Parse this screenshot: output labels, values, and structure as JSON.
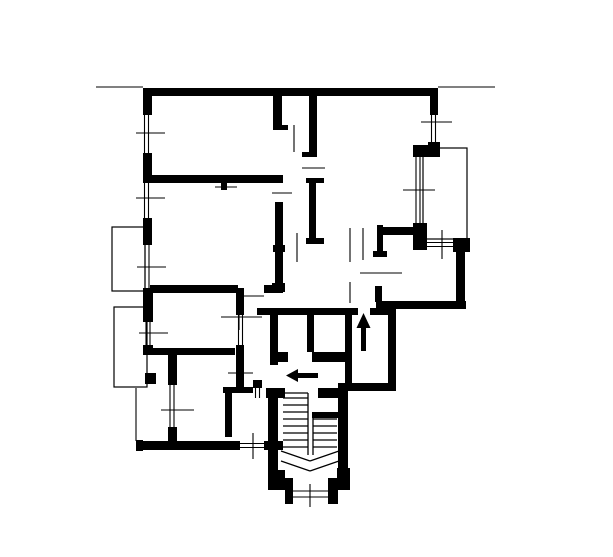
{
  "plan": {
    "background": "#ffffff",
    "ink": "#000000",
    "canvas": {
      "width": 613,
      "height": 557
    },
    "walls": [
      [
        143,
        88,
        295,
        8
      ],
      [
        143,
        88,
        9,
        27
      ],
      [
        143,
        153,
        9,
        30
      ],
      [
        143,
        218,
        9,
        27
      ],
      [
        143,
        288,
        10,
        34
      ],
      [
        143,
        345,
        10,
        10
      ],
      [
        143,
        348,
        92,
        7
      ],
      [
        168,
        355,
        9,
        30
      ],
      [
        168,
        427,
        9,
        14
      ],
      [
        136,
        440,
        7,
        11
      ],
      [
        136,
        441,
        104,
        9
      ],
      [
        264,
        441,
        19,
        9
      ],
      [
        268,
        390,
        10,
        82
      ],
      [
        268,
        470,
        17,
        20
      ],
      [
        285,
        478,
        8,
        20
      ],
      [
        285,
        496,
        8,
        8
      ],
      [
        328,
        496,
        10,
        8
      ],
      [
        328,
        478,
        10,
        20
      ],
      [
        337,
        468,
        13,
        22
      ],
      [
        338,
        398,
        10,
        72
      ],
      [
        266,
        388,
        19,
        10
      ],
      [
        318,
        388,
        30,
        10
      ],
      [
        338,
        383,
        58,
        8
      ],
      [
        388,
        313,
        8,
        72
      ],
      [
        376,
        301,
        90,
        8
      ],
      [
        375,
        286,
        7,
        16
      ],
      [
        456,
        250,
        9,
        55
      ],
      [
        453,
        238,
        17,
        14
      ],
      [
        413,
        223,
        14,
        27
      ],
      [
        413,
        145,
        27,
        12
      ],
      [
        430,
        88,
        8,
        27
      ],
      [
        428,
        142,
        12,
        13
      ],
      [
        273,
        96,
        9,
        34
      ],
      [
        282,
        125,
        6,
        5
      ],
      [
        309,
        96,
        8,
        61
      ],
      [
        302,
        152,
        7,
        5
      ],
      [
        152,
        175,
        131,
        8
      ],
      [
        221,
        183,
        6,
        7
      ],
      [
        275,
        202,
        8,
        43
      ],
      [
        273,
        245,
        12,
        7
      ],
      [
        275,
        252,
        8,
        31
      ],
      [
        272,
        283,
        13,
        9
      ],
      [
        309,
        178,
        7,
        65
      ],
      [
        306,
        178,
        18,
        5
      ],
      [
        306,
        238,
        18,
        6
      ],
      [
        257,
        308,
        101,
        7
      ],
      [
        370,
        308,
        26,
        7
      ],
      [
        270,
        315,
        8,
        37
      ],
      [
        307,
        315,
        7,
        37
      ],
      [
        345,
        315,
        7,
        68
      ],
      [
        278,
        352,
        10,
        10
      ],
      [
        312,
        352,
        33,
        10
      ],
      [
        270,
        352,
        8,
        13
      ],
      [
        377,
        225,
        6,
        32
      ],
      [
        373,
        251,
        14,
        6
      ],
      [
        377,
        227,
        43,
        8
      ],
      [
        236,
        288,
        8,
        27
      ],
      [
        236,
        345,
        8,
        48
      ],
      [
        223,
        387,
        30,
        6
      ],
      [
        225,
        387,
        7,
        50
      ],
      [
        253,
        380,
        9,
        8
      ],
      [
        150,
        285,
        88,
        8
      ],
      [
        264,
        285,
        19,
        8
      ],
      [
        312,
        412,
        26,
        6
      ]
    ],
    "windows": [
      {
        "lines": [
          [
            144.5,
            115,
            144.5,
            153
          ],
          [
            148.5,
            115,
            148.5,
            153
          ]
        ],
        "tick": [
          136,
          133,
          165,
          133
        ]
      },
      {
        "lines": [
          [
            144.5,
            183,
            144.5,
            218
          ],
          [
            148.5,
            183,
            148.5,
            218
          ]
        ],
        "tick": [
          136,
          198,
          165,
          198
        ]
      },
      {
        "lines": [
          [
            145,
            245,
            145,
            288
          ],
          [
            149,
            245,
            149,
            288
          ]
        ],
        "tick": [
          137,
          267,
          166,
          267
        ]
      },
      {
        "lines": [
          [
            146,
            322,
            146,
            345
          ],
          [
            150,
            322,
            150,
            345
          ]
        ],
        "tick": [
          139,
          333,
          168,
          333
        ]
      },
      {
        "lines": [
          [
            170,
            385,
            170,
            427
          ],
          [
            174,
            385,
            174,
            427
          ]
        ],
        "tick": [
          161,
          410,
          194,
          410
        ]
      },
      {
        "lines": [
          [
            240,
            443.5,
            264,
            443.5
          ],
          [
            240,
            447.5,
            264,
            447.5
          ]
        ],
        "tick": [
          253,
          433,
          253,
          459
        ]
      },
      {
        "lines": [
          [
            293,
            491,
            328,
            491
          ],
          [
            293,
            497,
            328,
            497
          ]
        ],
        "tick": [
          310,
          484,
          310,
          507
        ]
      },
      {
        "lines": [
          [
            431.5,
            115,
            431.5,
            142
          ],
          [
            435.5,
            115,
            435.5,
            142
          ]
        ],
        "tick": [
          421,
          122,
          452,
          122
        ]
      },
      {
        "lines": [
          [
            416,
            157,
            416,
            223
          ],
          [
            420,
            157,
            420,
            223
          ]
        ],
        "tick": [
          403,
          190,
          435,
          190
        ]
      },
      {
        "lines": [
          [
            427,
            242.5,
            453,
            242.5
          ],
          [
            427,
            246.5,
            453,
            246.5
          ]
        ],
        "tick": [
          442,
          230,
          442,
          259
        ]
      }
    ],
    "balconies": [
      {
        "x": 112,
        "y": 227,
        "w": 33,
        "h": 64
      },
      {
        "x": 114,
        "y": 307,
        "w": 33,
        "h": 80
      },
      {
        "x": 423,
        "y": 148,
        "w": 44,
        "h": 91
      }
    ],
    "door_lines": [
      [
        294,
        125,
        294,
        152
      ],
      [
        302,
        168,
        325,
        168
      ],
      [
        272,
        193,
        292,
        193
      ],
      [
        297,
        233,
        297,
        262
      ],
      [
        350,
        228,
        350,
        262
      ],
      [
        363,
        228,
        363,
        260
      ],
      [
        360,
        273,
        402,
        273
      ],
      [
        350,
        282,
        350,
        303
      ],
      [
        238,
        296,
        264,
        296
      ],
      [
        239,
        298,
        239,
        330
      ],
      [
        221,
        317,
        262,
        317
      ],
      [
        238.5,
        315,
        238.5,
        345
      ],
      [
        242.5,
        315,
        242.5,
        345
      ],
      [
        228,
        373,
        253,
        373
      ],
      [
        255.5,
        380,
        255.5,
        398
      ],
      [
        259.5,
        380,
        259.5,
        398
      ]
    ],
    "annotation_lines": [
      [
        96,
        87,
        143,
        87
      ],
      [
        438,
        87,
        495,
        87
      ],
      [
        136,
        388,
        136,
        441
      ],
      [
        215,
        187,
        237,
        187
      ]
    ],
    "stairs": {
      "treads": [
        [
          283,
          398,
          308,
          398
        ],
        [
          283,
          405,
          308,
          405
        ],
        [
          283,
          412,
          308,
          412
        ],
        [
          283,
          419,
          308,
          419
        ],
        [
          283,
          426,
          308,
          426
        ],
        [
          283,
          433,
          308,
          433
        ],
        [
          283,
          440,
          308,
          440
        ],
        [
          283,
          447,
          308,
          447
        ],
        [
          313,
          419,
          337,
          419
        ],
        [
          313,
          426,
          337,
          426
        ],
        [
          313,
          433,
          337,
          433
        ],
        [
          313,
          440,
          337,
          440
        ],
        [
          313,
          447,
          337,
          447
        ]
      ],
      "stringers": [
        [
          308,
          393,
          308,
          455
        ],
        [
          313,
          414,
          313,
          455
        ],
        [
          283,
          393,
          308,
          393
        ]
      ],
      "break_lines": [
        [
          281,
          451,
          310,
          461
        ],
        [
          310,
          461,
          339,
          451
        ],
        [
          281,
          461,
          310,
          471
        ],
        [
          310,
          471,
          339,
          461
        ]
      ]
    },
    "arrows": [
      {
        "name": "entry-direction-arrow",
        "shaft": [
          296,
          373,
          22,
          5
        ],
        "head": [
          [
            286,
            375.5
          ],
          [
            298,
            369
          ],
          [
            298,
            382
          ]
        ]
      },
      {
        "name": "up-direction-arrow",
        "shaft": [
          361,
          327,
          5,
          24
        ],
        "head": [
          [
            363.5,
            313
          ],
          [
            356.5,
            328
          ],
          [
            370.5,
            328
          ]
        ]
      }
    ],
    "column": {
      "x": 145,
      "y": 373,
      "w": 11,
      "h": 11
    }
  }
}
